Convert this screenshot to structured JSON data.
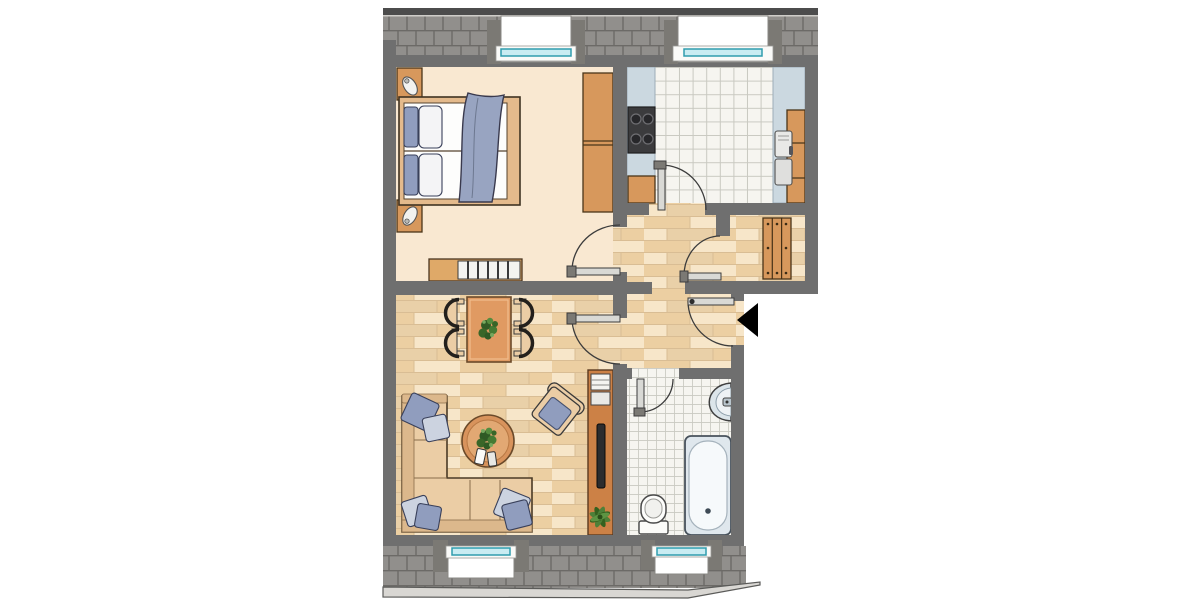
{
  "type": "floor-plan",
  "description": "Top-down architectural floor plan of a two-room attic apartment with sloped-roof bands and dormer windows at top and bottom, and a black arrow marking the entrance on the right side",
  "colors": {
    "wall": "#6f6f6f",
    "roof": "#918f8c",
    "roofLine": "#6c6a67",
    "roofBar": "#4c4c4c",
    "eave": "#d9d7d3",
    "eaveEdge": "#5b5b59",
    "bedroomFloor": "#f9e8d1",
    "parquet1": "#f1dcba",
    "parquet2": "#eccfa2",
    "parquet3": "#f7e6c9",
    "parquet4": "#e9d0a8",
    "parquetLine": "#d9bd94",
    "tile": "#f6f5f0",
    "tileLine": "#c9c9c1",
    "counter": "#cbd8e0",
    "counterEdge": "#9cadb8",
    "wood": "#d7985c",
    "woodDark": "#4a3519",
    "bedFrame": "#e4ba8c",
    "mattress": "#fdfdfc",
    "pillowBlue": "#909dbe",
    "pillowLight": "#ccd3e0",
    "pillowEdge": "#39405a",
    "blanket": "#98a4c1",
    "sofa": "#ebcda5",
    "sofaShade": "#dcb88c",
    "sofaEdge": "#4a3a26",
    "tableWood": "#e09a62",
    "tableEdge": "#6b4a2a",
    "plantDark": "#2f5a25",
    "plantMid": "#457a33",
    "plantLight": "#76a85e",
    "fixture": "#fdfdfb",
    "fixtureEdge": "#4a4a4a",
    "tub": "#dfe7ed",
    "tubInner": "#f6f9fb",
    "tubEdge": "#48525c",
    "sink": "#dce5ea",
    "glass": "#c9ecf2",
    "glassEdge": "#2f9cae",
    "jamb": "#7b7974",
    "recess": "#ffffff",
    "recessEdge": "#8a8884",
    "leaf": "#d9d9d5",
    "leafEdge": "#3c3c3c",
    "arc": "#3c3c3c",
    "stove": "#3b3b3d",
    "burner": "#27272a",
    "burnerEdge": "#6e6e72",
    "tv": "#2c2c2e",
    "slat": "#f4f4f0",
    "arrow": "#000000"
  },
  "rooms": [
    {
      "id": "bedroom",
      "floor": "cream",
      "furniture": [
        "double-bed",
        "pillows",
        "blanket",
        "nightstand-upper",
        "nightstand-lower",
        "table-lamps",
        "wardrobe",
        "dresser-radiator"
      ]
    },
    {
      "id": "kitchen",
      "floor": "large-tiles",
      "furniture": [
        "counter-left",
        "stove-4-burner",
        "base-cabinet",
        "counter-right",
        "double-sink",
        "cabinet-column"
      ]
    },
    {
      "id": "hallway",
      "floor": "parquet",
      "furniture": []
    },
    {
      "id": "storage-niche",
      "floor": "parquet",
      "furniture": [
        "slatted-shelf"
      ]
    },
    {
      "id": "living-room",
      "floor": "parquet",
      "furniture": [
        "dining-table",
        "dining-chairs-x4",
        "table-plant",
        "corner-sofa",
        "sofa-pillows-x5",
        "round-coffee-table",
        "coffee-table-plant",
        "remote-controls",
        "armchair",
        "tv-sideboard",
        "tv",
        "media-boxes",
        "palm-plant"
      ]
    },
    {
      "id": "bathroom",
      "floor": "small-tiles",
      "furniture": [
        "washbasin",
        "toilet",
        "bathtub"
      ]
    }
  ],
  "doors": [
    "bedroom-door",
    "kitchen-door",
    "storage-niche-door",
    "living-room-door",
    "entrance-door",
    "bathroom-door"
  ],
  "windows": [
    "bedroom-dormer-window",
    "kitchen-dormer-window",
    "living-room-dormer-window",
    "bathroom-dormer-window"
  ],
  "entrance_marker": "black-arrow-pointing-left"
}
